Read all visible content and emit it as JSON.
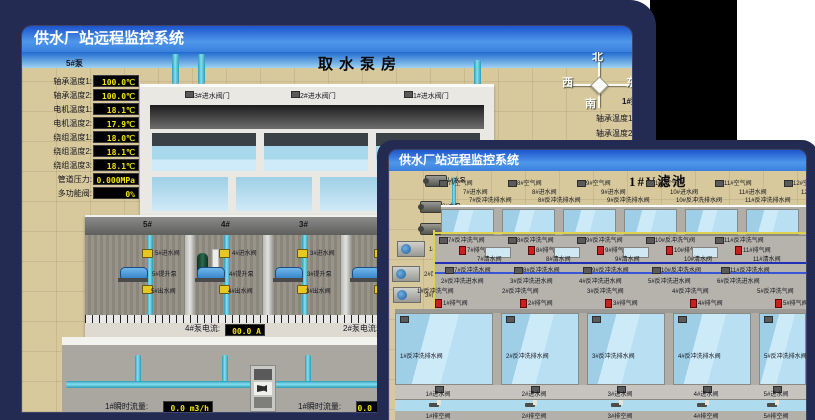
{
  "back_window": {
    "title": "供水厂站远程监控系统",
    "scene_title": "取水泵房",
    "pump_panel": {
      "header": "5#泵",
      "rows": [
        {
          "label": "轴承温度1:",
          "value": "100.0℃"
        },
        {
          "label": "轴承温度2:",
          "value": "100.0℃"
        },
        {
          "label": "电机温度1:",
          "value": "18.1℃"
        },
        {
          "label": "电机温度2:",
          "value": "17.9℃"
        },
        {
          "label": "绕组温度1:",
          "value": "18.0℃"
        },
        {
          "label": "绕组温度2:",
          "value": "18.1℃"
        },
        {
          "label": "绕组温度3:",
          "value": "18.1℃"
        },
        {
          "label": "管道压力:",
          "value": "0.000MPa"
        },
        {
          "label": "多功能阀:",
          "value": "0%"
        }
      ]
    },
    "inlet_valves": [
      "3#进水阀门",
      "2#进水阀门",
      "1#进水阀门"
    ],
    "compass": {
      "north": "北",
      "west": "西",
      "south": "南",
      "east": "东"
    },
    "right_panel": {
      "header": "1#泵",
      "labels": [
        "轴承温度1:",
        "轴承温度2:"
      ]
    },
    "bays": [
      {
        "no": "5#",
        "inlet": "5#进水阀",
        "pump": "5#提升泵",
        "outlet": "5#出水阀"
      },
      {
        "no": "4#",
        "inlet": "4#进水阀",
        "pump": "4#提升泵",
        "outlet": "4#出水阀"
      },
      {
        "no": "3#",
        "inlet": "3#进水阀",
        "pump": "3#提升泵",
        "outlet": "3#出水阀"
      },
      {
        "no": "2#",
        "inlet": "2#进水阀",
        "pump": "2#提升泵",
        "outlet": "2#出水阀"
      }
    ],
    "current_readouts": [
      {
        "label": "4#泵电流:",
        "value": "00.0 A"
      },
      {
        "label": "2#泵电流:",
        "value": "00.0 A"
      }
    ],
    "flow_readouts": [
      {
        "label": "1#瞬时流量:",
        "value": "0.0 m3/h"
      },
      {
        "label": "1#瞬时流量:",
        "value": "0.0 m3/h"
      }
    ]
  },
  "front_window": {
    "title": "供水厂站远程监控系统",
    "scene_title": "1#V滤池",
    "pumps": [
      "1#水泵",
      "2#水泵",
      "3#水泵"
    ],
    "fans": [
      "1#风机",
      "2#风机",
      "3#风机"
    ],
    "top_cols": [
      {
        "air": "7#空气阀",
        "inlet": "7#进水阀",
        "drain": "7#反冲洗排水阀"
      },
      {
        "air": "8#空气阀",
        "inlet": "8#进水阀",
        "drain": "8#反冲洗排水阀"
      },
      {
        "air": "9#空气阀",
        "inlet": "9#进水阀",
        "drain": "9#反冲洗排水阀"
      },
      {
        "air": "10#空气阀",
        "inlet": "10#进水阀",
        "drain": "10#反冲洗排水阀"
      },
      {
        "air": "11#空气阀",
        "inlet": "11#进水阀",
        "drain": "11#反冲洗排水阀"
      },
      {
        "air": "12#空气阀",
        "inlet": "12#进水阀",
        "drain": "12#反冲洗排水阀"
      }
    ],
    "mid_rows": {
      "backwash_air": [
        "7#反冲洗气阀",
        "8#反冲洗气阀",
        "9#反冲洗气阀",
        "10#反冲洗气阀",
        "11#反冲洗气阀"
      ],
      "exhaust": [
        "7#排气阀",
        "8#排气阀",
        "9#排气阀",
        "10#排气阀",
        "11#排气阀"
      ],
      "clean": [
        "7#清水阀",
        "8#清水阀",
        "9#清水阀",
        "10#清水阀",
        "11#清水阀"
      ],
      "backwash_water": [
        "7#反冲洗水阀",
        "8#反冲洗水阀",
        "9#反冲洗水阀",
        "10#反冲洗水阀",
        "11#反冲洗水阀"
      ],
      "backwash_inlet": [
        "2#反冲洗进水阀",
        "3#反冲洗进水阀",
        "4#反冲洗进水阀",
        "5#反冲洗进水阀",
        "6#反冲洗进水阀"
      ],
      "backwash_air2": [
        "1#反冲洗气阀",
        "2#反冲洗气阀",
        "3#反冲洗气阀",
        "4#反冲洗气阀",
        "5#反冲洗气阀"
      ]
    },
    "lower": {
      "exhaust": [
        "1#排气阀",
        "2#排气阀",
        "3#排气阀",
        "4#排气阀",
        "5#排气阀"
      ],
      "drain": [
        "1#反冲洗排水阀",
        "2#反冲洗排水阀",
        "3#反冲洗排水阀",
        "4#反冲洗排水阀",
        "5#反冲洗排水阀"
      ],
      "inlet": [
        "1#进水阀",
        "2#进水阀",
        "3#进水阀",
        "4#进水阀",
        "5#进水阀"
      ],
      "vent": [
        "1#排空阀",
        "2#排空阀",
        "3#排空阀",
        "4#排空阀",
        "5#排空阀"
      ]
    }
  }
}
